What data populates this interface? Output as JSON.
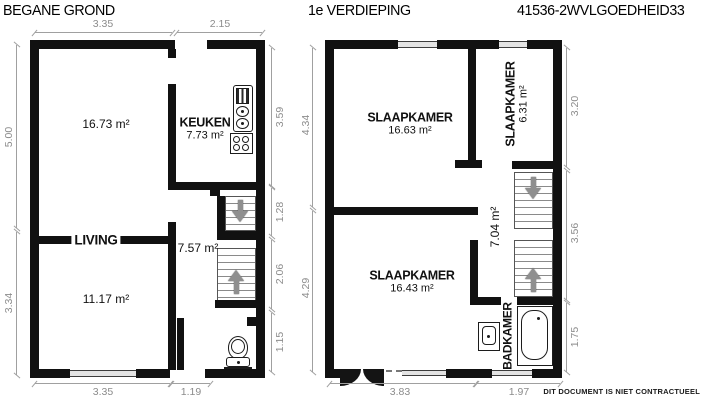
{
  "document": {
    "title_left": "BEGANE GROND",
    "title_right": "1e VERDIEPING",
    "reference_code": "41536-2WVLGOEDHEID33",
    "disclaimer": "DIT DOCUMENT IS NIET CONTRACTUEEL"
  },
  "colors": {
    "wall": "#111111",
    "dimension": "#8c8c8c",
    "stair_arrow": "#8f8f8f"
  },
  "icons": [
    "stairs-up-arrow",
    "stairs-down-arrow",
    "toilet",
    "kitchen-sink",
    "stove",
    "washbasin",
    "bathtub",
    "window",
    "door-swing-arc"
  ],
  "ground_floor": {
    "rooms": {
      "main": {
        "area": "16.73 m²"
      },
      "kitchen": {
        "label": "KEUKEN",
        "area": "7.73 m²"
      },
      "living": {
        "label": "LIVING",
        "area": "11.17 m²"
      },
      "hall": {
        "area": "7.57 m²"
      }
    },
    "dims": {
      "top": [
        "3.35",
        "2.15"
      ],
      "left": [
        "5.00",
        "3.34"
      ],
      "right": [
        "3.59",
        "1.28",
        "2.06",
        "1.15"
      ],
      "bottom": [
        "3.35",
        "1.19"
      ]
    }
  },
  "first_floor": {
    "rooms": {
      "bedroom_back": {
        "label": "SLAAPKAMER",
        "area": "16.63 m²"
      },
      "bedroom_small": {
        "label": "SLAAPKAMER",
        "area": "6.31 m²"
      },
      "bedroom_front": {
        "label": "SLAAPKAMER",
        "area": "16.43 m²"
      },
      "hall": {
        "area": "7.04 m²"
      },
      "bathroom": {
        "label": "BADKAMER"
      }
    },
    "dims": {
      "left": [
        "4.34",
        "4.29"
      ],
      "right": [
        "3.20",
        "3.56",
        "1.75"
      ],
      "bottom": [
        "3.83",
        "1.97"
      ]
    }
  }
}
